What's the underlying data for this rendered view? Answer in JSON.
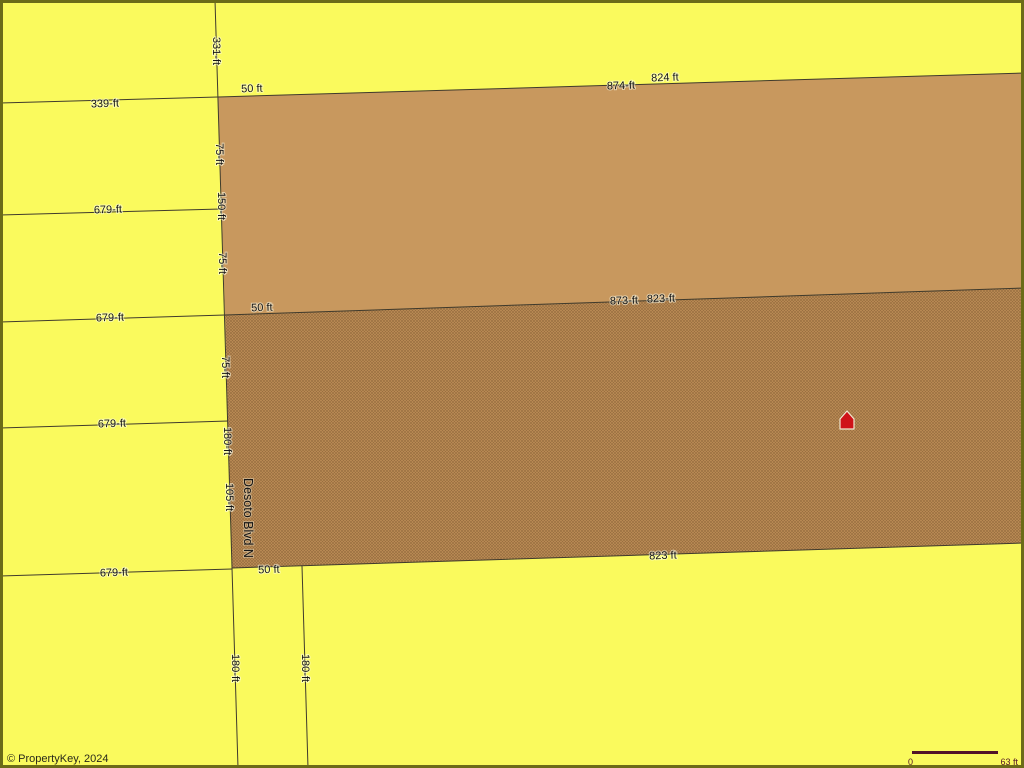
{
  "map": {
    "street": {
      "name": "Desoto Blvd N"
    },
    "marker_icon": "house-icon",
    "left_boundary_lines": [
      {
        "label": "339-ft"
      },
      {
        "label": "679-ft"
      },
      {
        "label": "679-ft"
      },
      {
        "label": "679-ft"
      },
      {
        "label": "679-ft"
      }
    ],
    "road_segments": [
      {
        "label": "331-ft"
      },
      {
        "label": "75-ft"
      },
      {
        "label": "150-ft"
      },
      {
        "label": "75-ft"
      },
      {
        "label": "75-ft"
      },
      {
        "label": "180-ft"
      },
      {
        "label": "105-ft"
      },
      {
        "label": "180-ft"
      },
      {
        "label": "180-ft"
      }
    ],
    "road_width_labels": [
      "50 ft",
      "50 ft",
      "50 ft"
    ],
    "upper_parcel": {
      "north_edge_labels": [
        "874-ft",
        "824 ft"
      ]
    },
    "lower_parcel": {
      "north_edge_labels": [
        "873-ft",
        "823-ft"
      ],
      "south_edge_label": "823 ft"
    }
  },
  "footer": {
    "attribution": "© PropertyKey, 2024",
    "scale_bar": {
      "start_label": "0",
      "end_label": "63 ft"
    }
  },
  "colors": {
    "background": "#fafa5d",
    "parcel_upper": "#c8985e",
    "parcel_lower_base": "#c09058",
    "hatch_line": "#6e4b28",
    "boundary_line": "#3f3a2c",
    "map_border": "#6b6b18",
    "house_red": "#cf1318",
    "house_outline": "#f0e8d0",
    "scale_bar": "#511427",
    "label_text": "#141414"
  }
}
